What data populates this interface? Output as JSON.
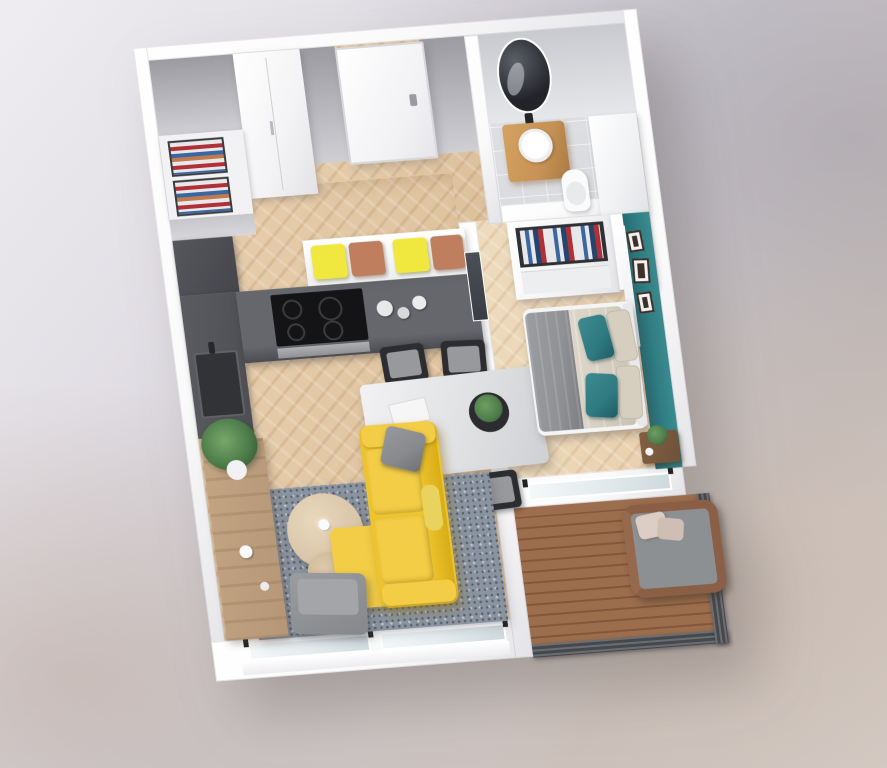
{
  "scene": {
    "type": "isometric-3d-floor-plan-render",
    "description": "3D rendered floor plan of a one-bedroom apartment with open kitchen-living room, entry hall, bathroom, bedroom with teal accent wall and a balcony",
    "visible_text": []
  },
  "palette": {
    "wall-white": "#fafafa",
    "wall-shade": "#e4e4e8",
    "wall-face-dark": "#9b9ba1",
    "wall-face-light": "#cfcfd4",
    "floor-wood": "#e8cfad",
    "floor-wood-dark": "#dcc09c",
    "floor-bed": "#eedbbd",
    "tile": "#d8d9dc",
    "counter-dark": "#5a5c61",
    "counter-darker": "#44464b",
    "cooktop": "#141416",
    "steel": "#aeb0b3",
    "cushion-yellow": "#f0e83e",
    "cushion-terra": "#bf7f5f",
    "sofa-yellow": "#edc32f",
    "sofa-yellow-dark": "#d8ad16",
    "sofa-yellow-light": "#f2cd45",
    "pillow-gray": "#87898d",
    "rug-blue": "#8a94a0",
    "table-top": "#e0e1e3",
    "chair-dark": "#2b2d30",
    "chair-seat": "#97999c",
    "wood-sideboard": "#b59778",
    "wood-coffee": "#d9c5a9",
    "wood-coffee-dark": "#ccb795",
    "plant-green": "#4d7c4a",
    "teal": "#2f7b81",
    "teal-pillow": "#2e7a80",
    "duvet-beige": "#d9d2c5",
    "blanket-gray": "#8f9195",
    "pillow-beige": "#d6cfc0",
    "nightstand-wood": "#6f5239",
    "vanity-wood": "#c79255",
    "mirror-dark": "#23242a",
    "deck-wood": "#9c6e4d",
    "deck-gap": "#83573b",
    "railing": "#46484c",
    "rattan": "#8a5f45",
    "chair-cushion": "#8d9093",
    "glass": "#e7eef0",
    "door-glass": "#3a3e44",
    "clothes-red": "#b03038",
    "clothes-blue": "#3a67a0",
    "clothes-navy": "#23456e",
    "clothes-white": "#e8e8ea",
    "clothes-terra": "#c07a50"
  },
  "rooms": [
    {
      "name": "entry-hall",
      "furniture": [
        "entry-door",
        "hall-closet",
        "open-clothes-shelf"
      ]
    },
    {
      "name": "kitchen",
      "furniture": [
        "tall-unit",
        "counter-with-sink",
        "cooktop",
        "oven",
        "canisters",
        "window-bench",
        "seat-cushions"
      ]
    },
    {
      "name": "dining-area",
      "furniture": [
        "dining-table",
        "four-chairs",
        "centerpiece-plant",
        "book"
      ]
    },
    {
      "name": "living-room",
      "furniture": [
        "yellow-sofa",
        "gray-pillow",
        "chaise",
        "area-rug",
        "nesting-coffee-tables",
        "gray-armchair",
        "wood-sideboard",
        "large-plant",
        "windows"
      ]
    },
    {
      "name": "bathroom",
      "furniture": [
        "oval-mirror",
        "wood-vanity",
        "round-sink",
        "toilet",
        "tall-cabinet"
      ]
    },
    {
      "name": "bedroom",
      "furniture": [
        "open-wardrobe-with-clothes",
        "double-bed",
        "teal-pillows",
        "beige-pillows",
        "gray-throw",
        "teal-accent-wall",
        "picture-frames",
        "nightstand",
        "plant",
        "glass-door",
        "balcony-window"
      ]
    },
    {
      "name": "balcony",
      "furniture": [
        "wood-deck",
        "metal-railing",
        "rattan-armchair",
        "cushions"
      ]
    }
  ]
}
